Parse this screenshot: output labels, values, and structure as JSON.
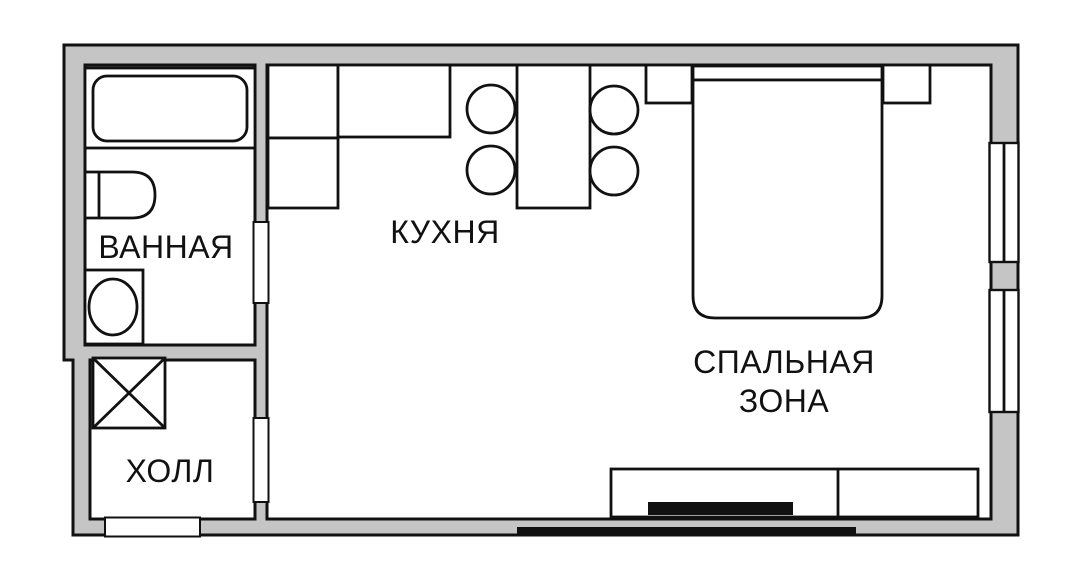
{
  "colors": {
    "wall_fill": "#c5c5c5",
    "line": "#111111",
    "background": "#ffffff",
    "tv_fill": "#111111"
  },
  "rooms": {
    "bathroom": {
      "label": "ВАННАЯ"
    },
    "kitchen": {
      "label": "КУХНЯ"
    },
    "sleeping_area": {
      "label_line1": "СПАЛЬНАЯ",
      "label_line2": "ЗОНА"
    },
    "hall": {
      "label": "ХОЛЛ"
    }
  },
  "furniture_symbols": [
    "bathtub",
    "toilet",
    "washbasin",
    "wardrobe-cross-square",
    "kitchen-counter-l-shape",
    "dining-table",
    "round-stool-x4",
    "double-bed-with-headboard",
    "nightstand-x2",
    "tv-stand",
    "tv-black-bar",
    "radiator-strip"
  ],
  "opening_symbols": [
    "window-right-wall-upper",
    "window-right-wall-lower",
    "entrance-door-opening-bottom-wall",
    "bathroom-door-opening",
    "hall-passage-opening"
  ]
}
